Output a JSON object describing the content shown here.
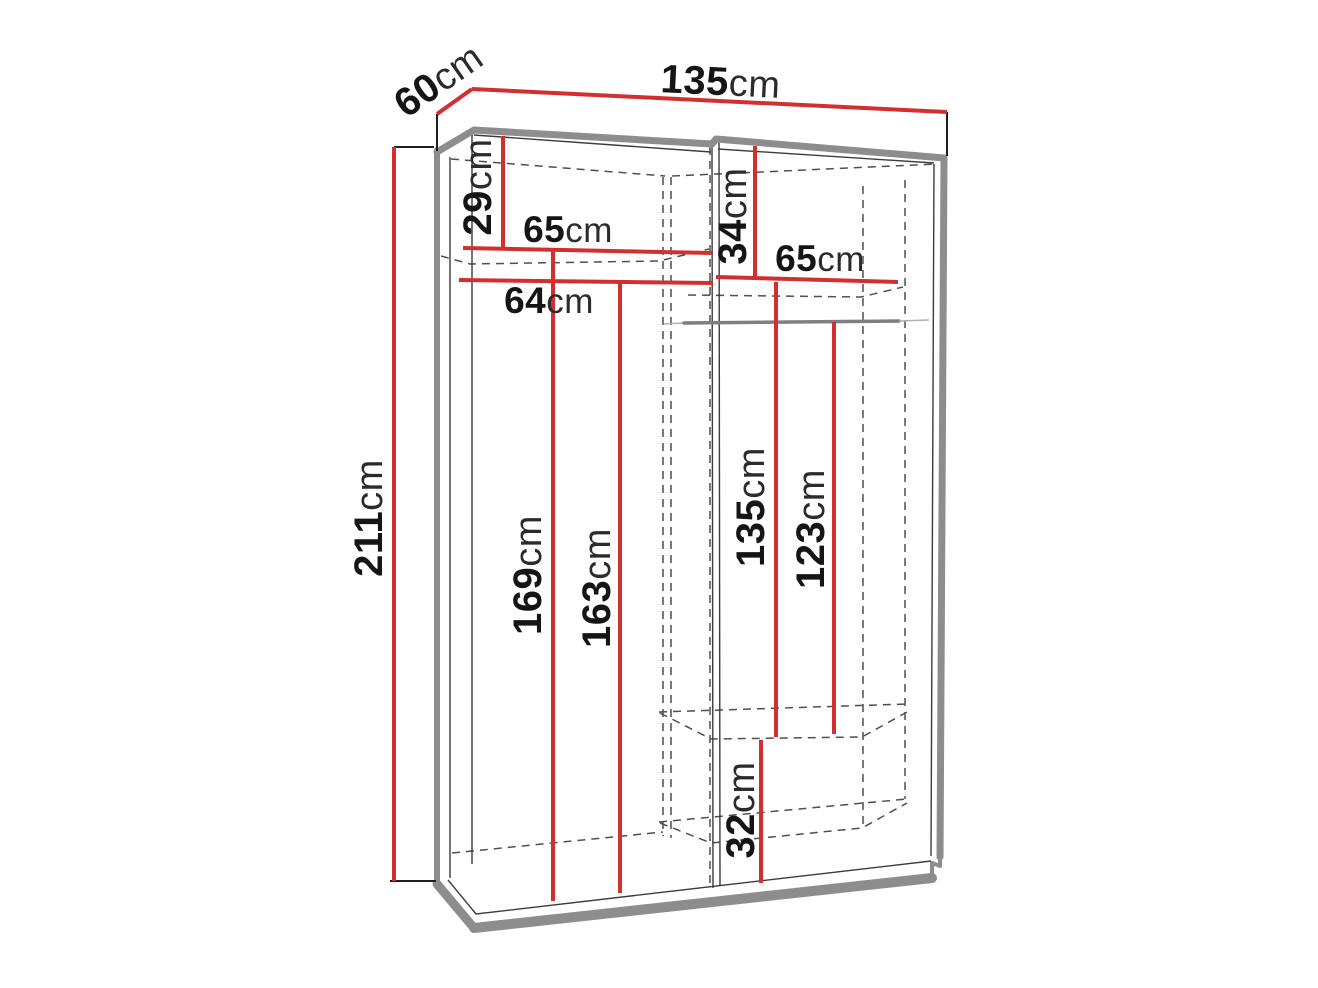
{
  "diagram_title": "Wardrobe dimensions diagram",
  "unit": "cm",
  "colors": {
    "dimension_red": "#d42f2f",
    "frame_gray": "#8d8d8d",
    "dashed_gray": "#4f4f4f",
    "text_black": "#151515",
    "background": "#ffffff"
  },
  "overall": {
    "width": {
      "value": "135",
      "unit": "cm"
    },
    "depth": {
      "value": "60",
      "unit": "cm"
    },
    "height": {
      "value": "211",
      "unit": "cm"
    }
  },
  "left_column": {
    "top_shelf_drop": {
      "value": "29",
      "unit": "cm"
    },
    "shelf_width": {
      "value": "65",
      "unit": "cm"
    },
    "inner_width": {
      "value": "64",
      "unit": "cm"
    },
    "inner_height_back": {
      "value": "169",
      "unit": "cm"
    },
    "inner_height_front": {
      "value": "163",
      "unit": "cm"
    }
  },
  "right_column": {
    "top_shelf_drop": {
      "value": "34",
      "unit": "cm"
    },
    "shelf_width": {
      "value": "65",
      "unit": "cm"
    },
    "upper_height": {
      "value": "135",
      "unit": "cm"
    },
    "rod_clearance": {
      "value": "123",
      "unit": "cm"
    },
    "base_height": {
      "value": "32",
      "unit": "cm"
    }
  }
}
